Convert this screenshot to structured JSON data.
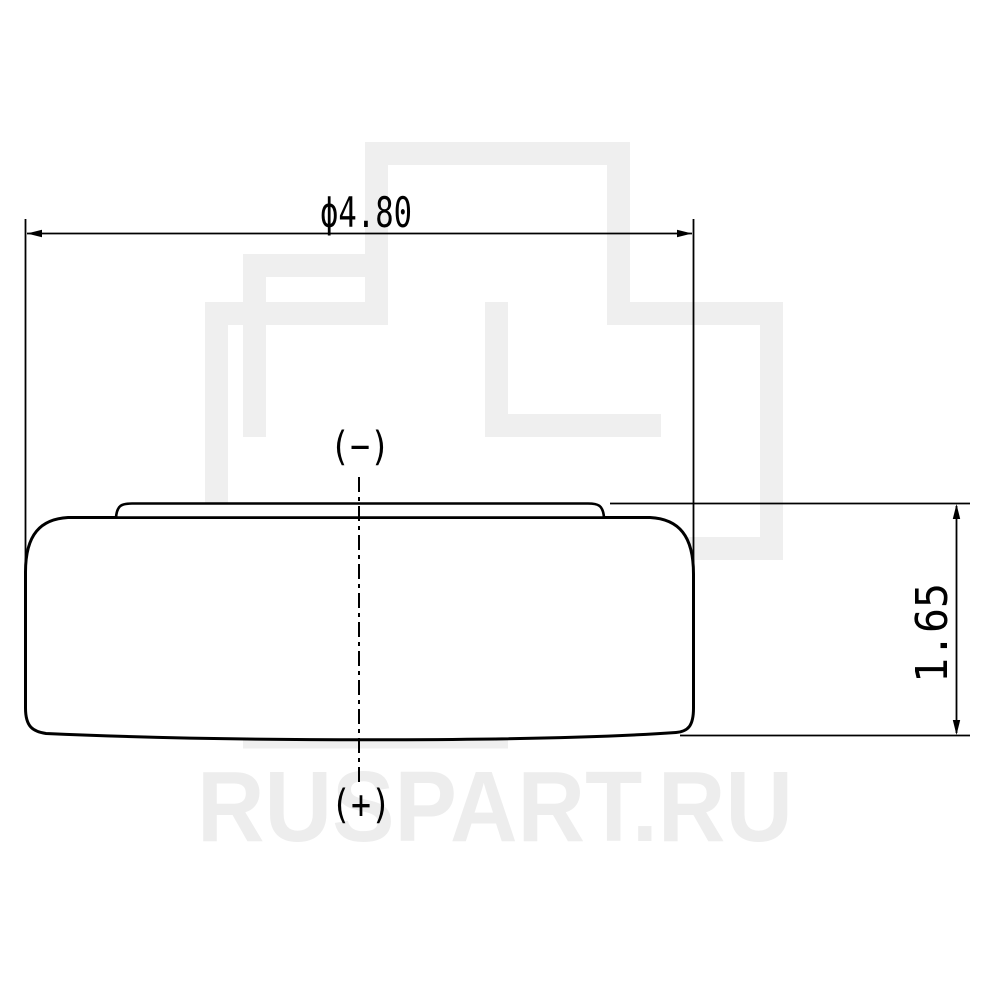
{
  "drawing": {
    "type": "technical-drawing-button-cell-battery-side-view",
    "dimensions": {
      "diameter_label": "ϕ4.80",
      "height_label": "1.65"
    },
    "terminals": {
      "negative_label": "(−)",
      "positive_label": "(+)"
    },
    "watermark": {
      "text": "RUSPART.RU",
      "logo": "double-interlocked-cross-outline",
      "color": "#efefef"
    },
    "colors": {
      "line": "#000000",
      "background": "#ffffff"
    }
  }
}
